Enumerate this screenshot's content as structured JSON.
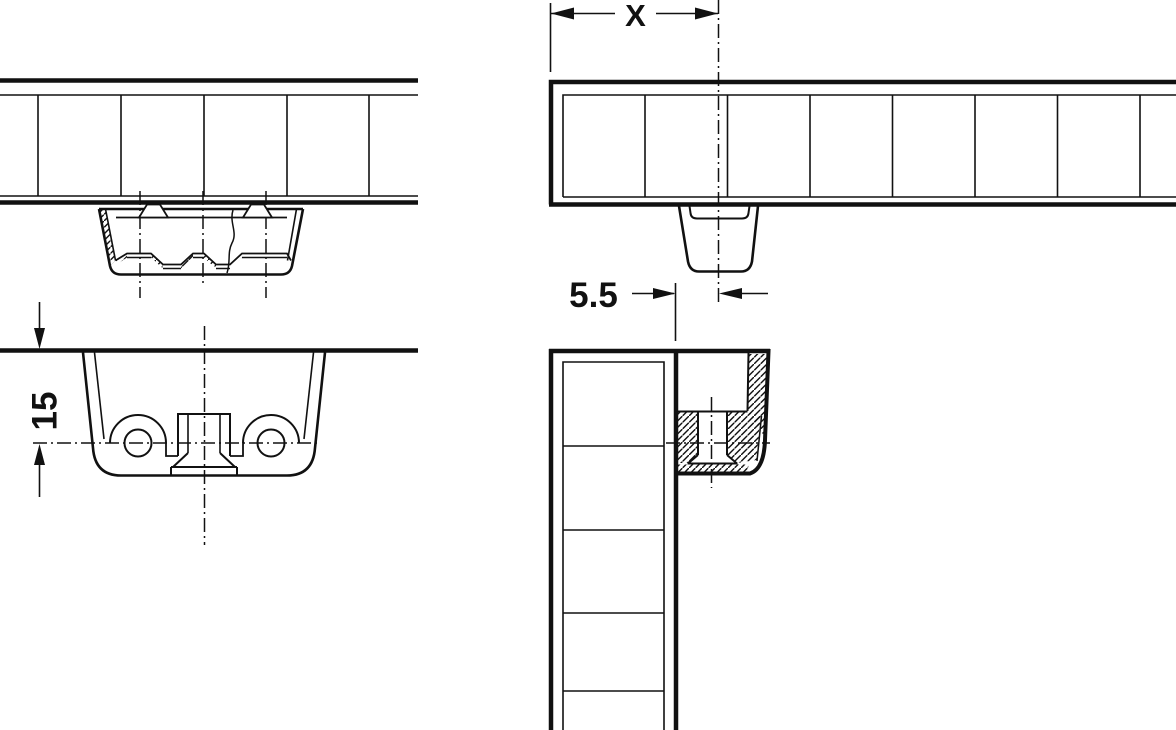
{
  "page": {
    "background": "#ffffff",
    "line_color": "#111111"
  },
  "labels": {
    "dim_x": "X",
    "dim_edge_distance": "5.5",
    "dim_depth": "15"
  }
}
